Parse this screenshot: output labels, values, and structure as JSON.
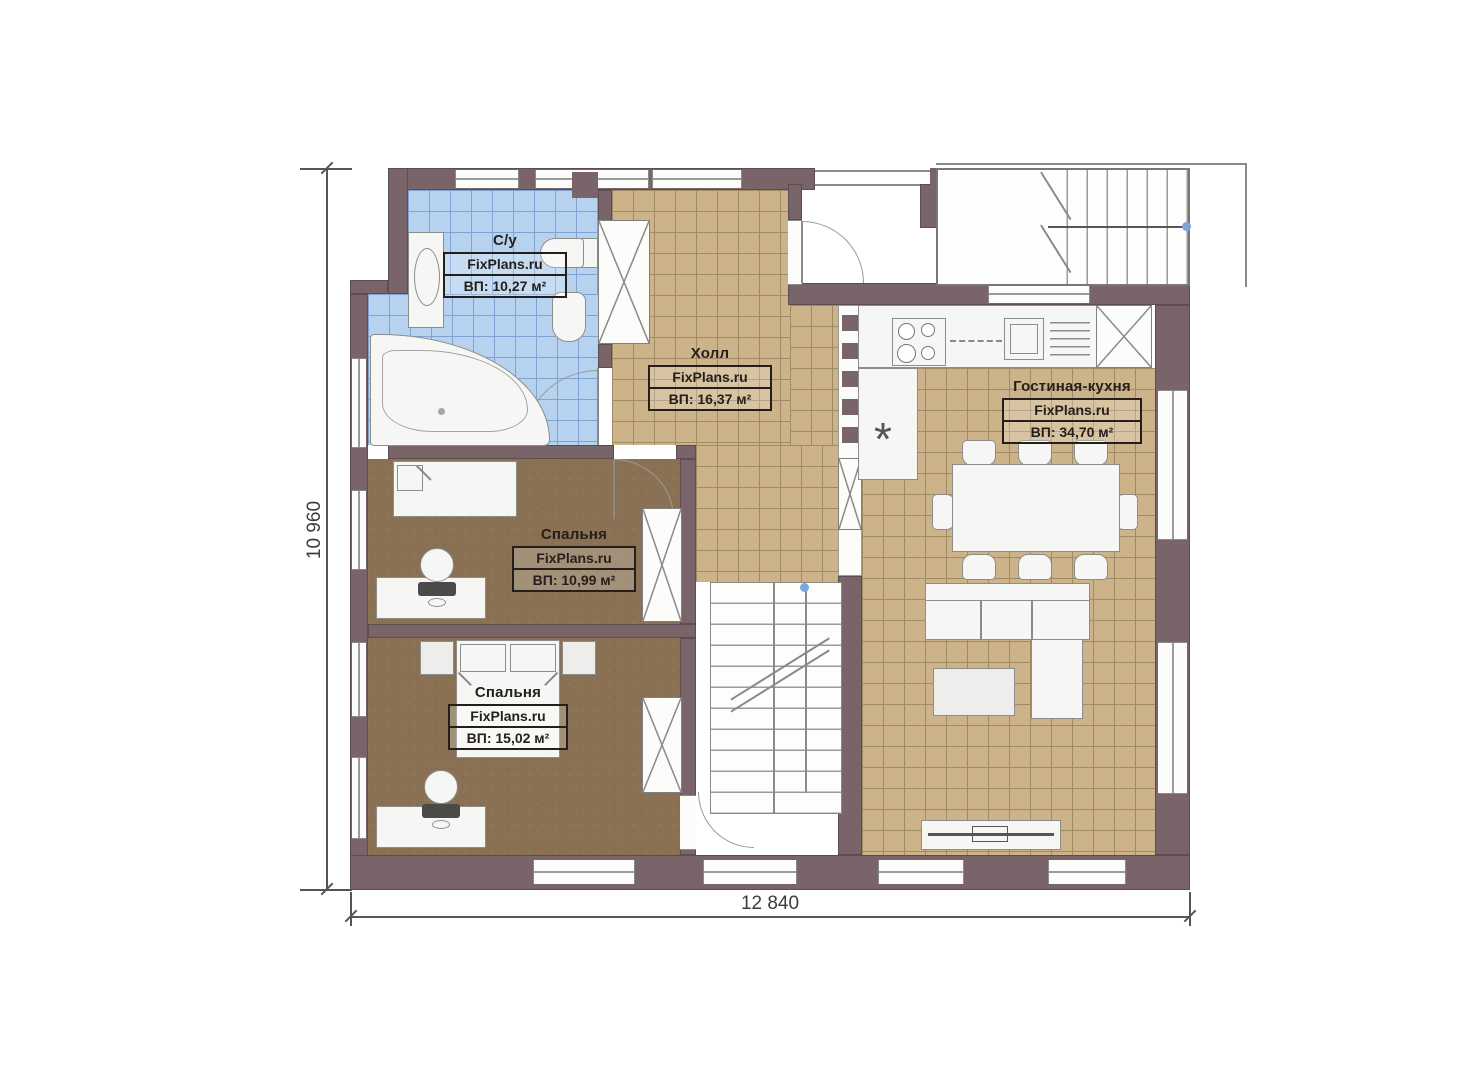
{
  "plan": {
    "dimensions": {
      "width_label": "12 840",
      "height_label": "10 960"
    },
    "rooms": {
      "bathroom": {
        "name": "С/у",
        "brand": "FixPlans.ru",
        "area": "ВП: 10,27 м²"
      },
      "hall": {
        "name": "Холл",
        "brand": "FixPlans.ru",
        "area": "ВП: 16,37 м²"
      },
      "living_kitchen": {
        "name": "Гостиная-кухня",
        "brand": "FixPlans.ru",
        "area": "ВП: 34,70 м²"
      },
      "bedroom_1": {
        "name": "Спальня",
        "brand": "FixPlans.ru",
        "area": "ВП: 10,99 м²"
      },
      "bedroom_2": {
        "name": "Спальня",
        "brand": "FixPlans.ru",
        "area": "ВП: 15,02 м²"
      }
    },
    "symbols": {
      "refrigerator": "*"
    },
    "colors": {
      "wall": "#796569",
      "bath_tile": "#b7d2ef",
      "hall_tile": "#cdb38a",
      "bedroom_floor": "#8a7154",
      "accent_dot": "#7ba6d9"
    }
  }
}
